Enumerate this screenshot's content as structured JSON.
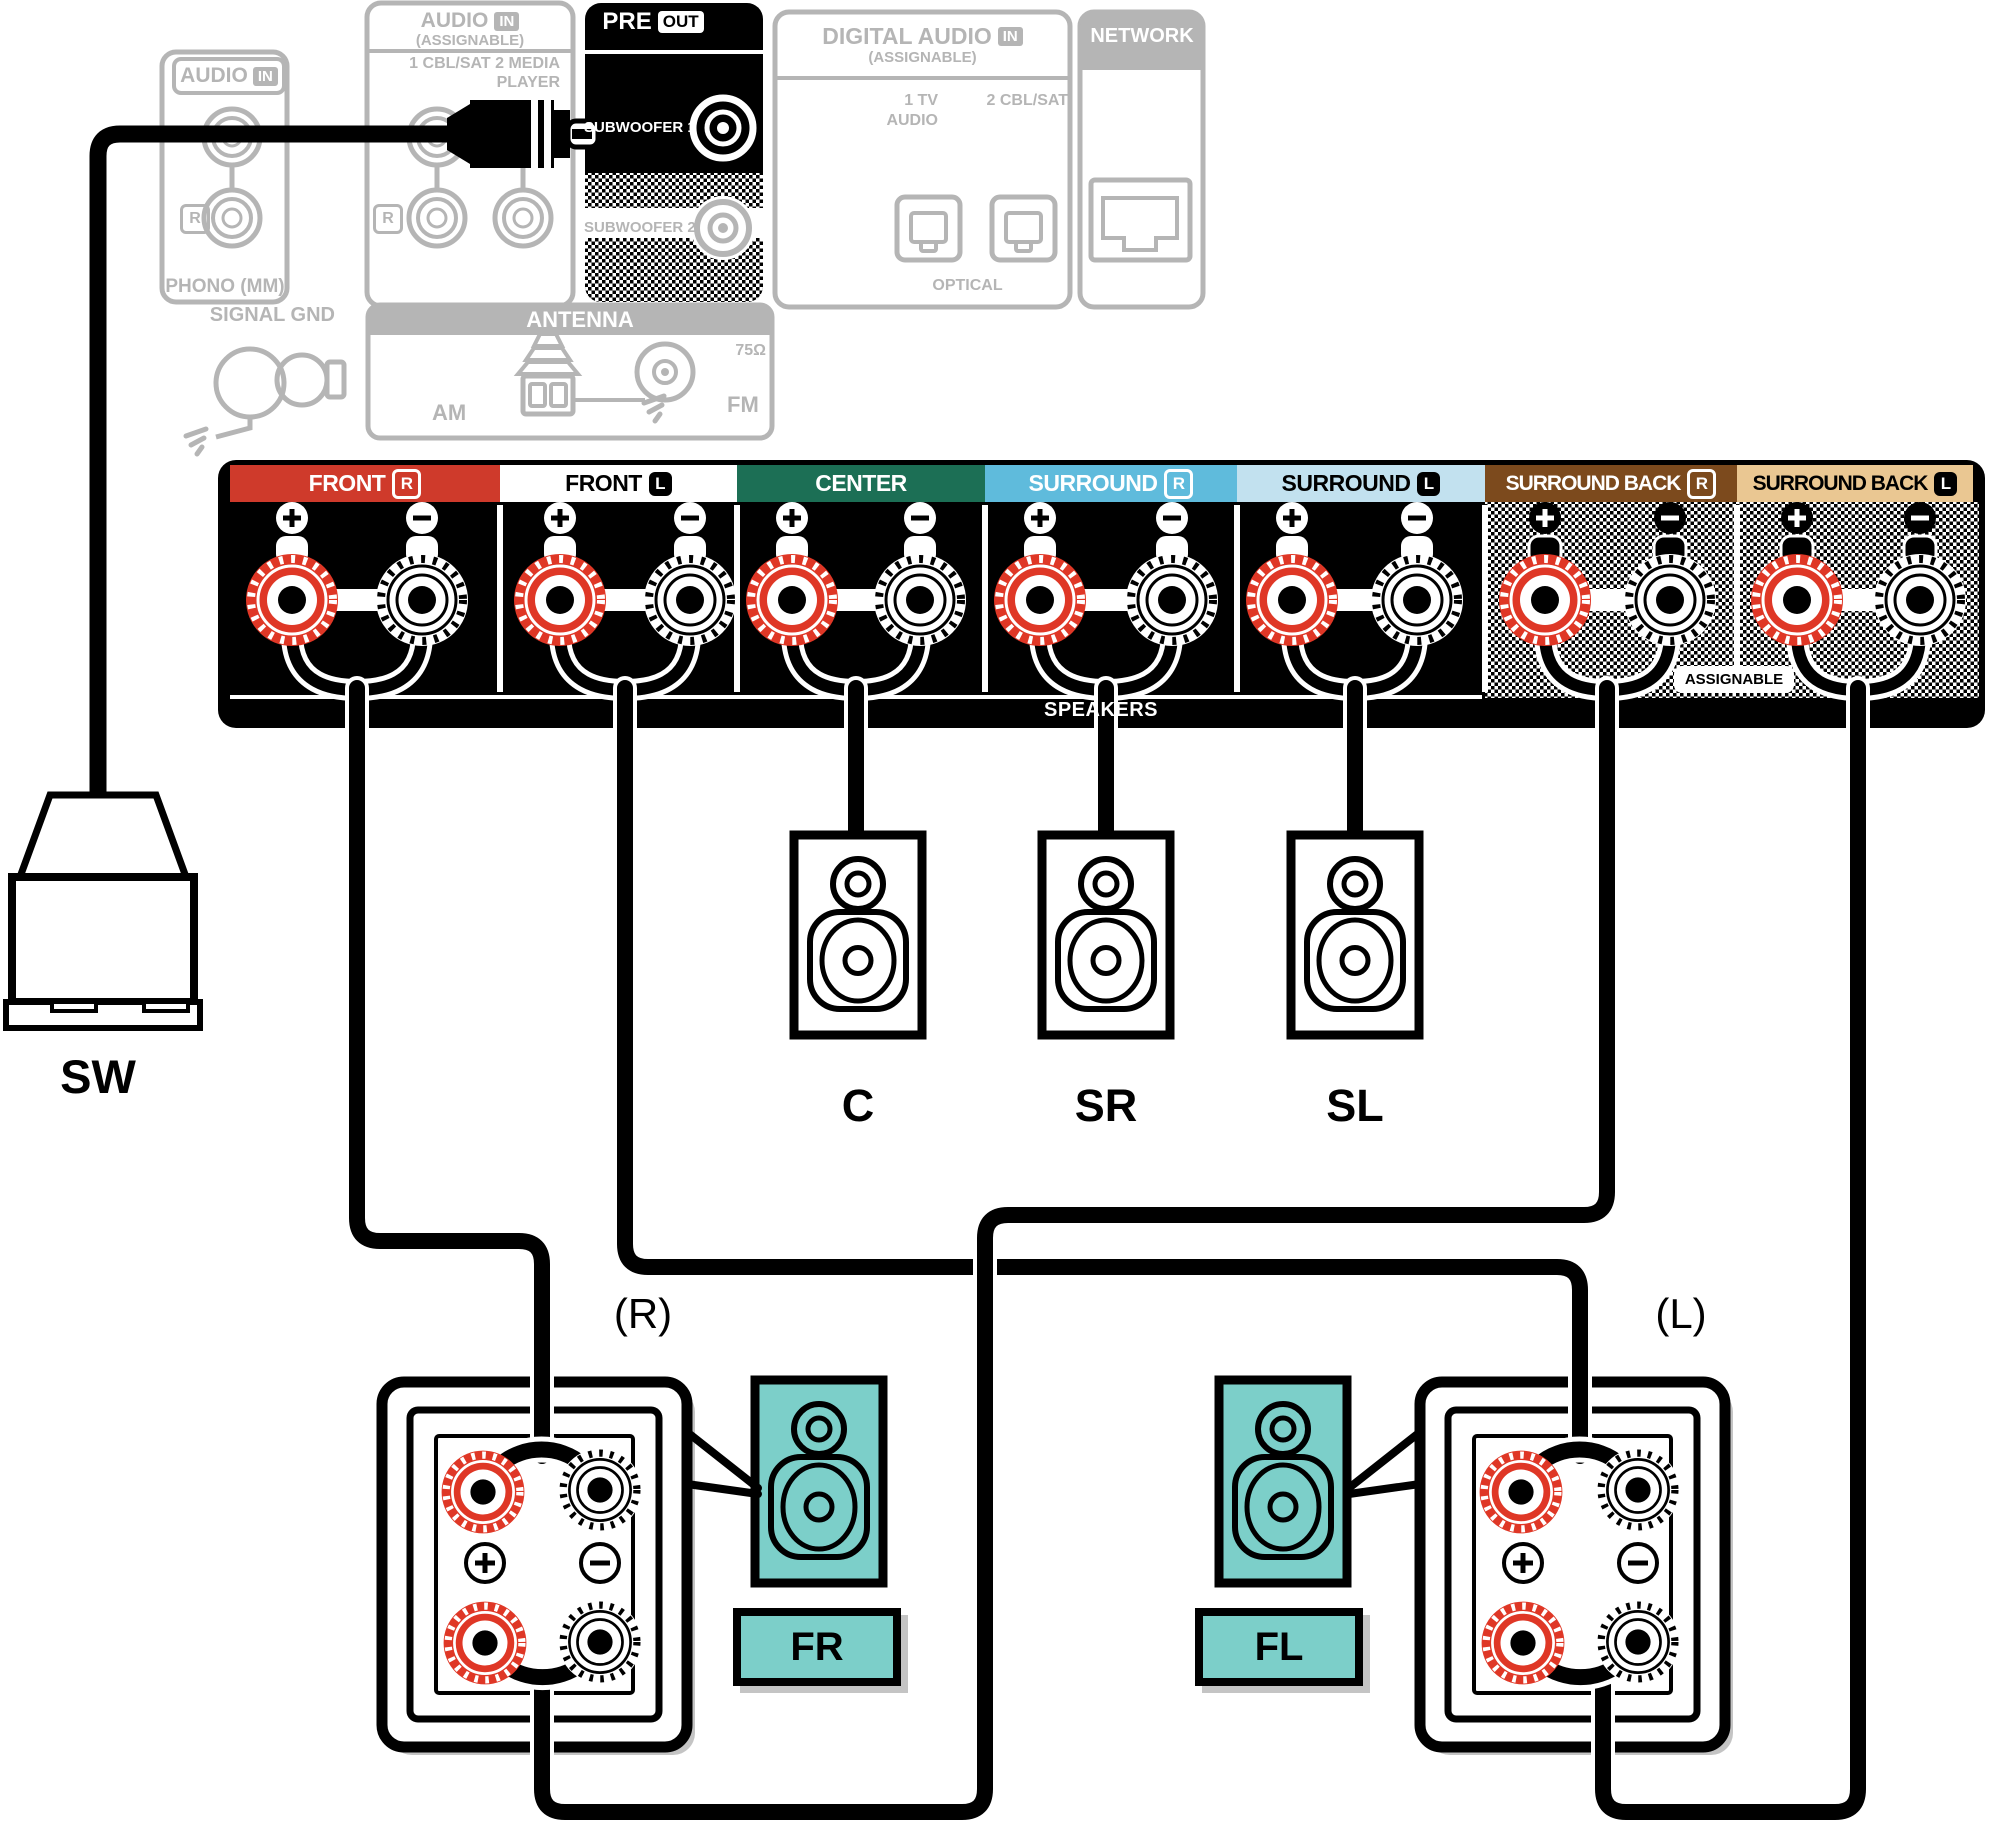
{
  "rear_panel": {
    "phono_section": {
      "header": "AUDIO",
      "header_badge": "IN",
      "channel": "R",
      "caption": "PHONO (MM)",
      "ground_label": "SIGNAL GND"
    },
    "assignable_audio_section": {
      "header": "AUDIO",
      "header_badge": "IN",
      "subheader": "(ASSIGNABLE)",
      "inputs_line1": "1 CBL/SAT  2 MEDIA",
      "inputs_line2": "PLAYER",
      "channel": "R"
    },
    "pre_out_section": {
      "header": "PRE",
      "header_badge": "OUT",
      "jack1": "SUBWOOFER 1",
      "jack2": "SUBWOOFER 2"
    },
    "digital_audio_section": {
      "header": "DIGITAL AUDIO",
      "header_badge": "IN",
      "subheader": "(ASSIGNABLE)",
      "input1_line1": "1  TV",
      "input1_line2": "AUDIO",
      "input2": "2 CBL/SAT",
      "caption": "OPTICAL"
    },
    "network_section": {
      "header": "NETWORK"
    },
    "antenna_section": {
      "header": "ANTENNA",
      "am_label": "AM",
      "fm_label": "FM",
      "impedance": "75Ω"
    }
  },
  "speaker_terminals": {
    "sections": [
      {
        "label": "FRONT",
        "badge": "R",
        "bg": "#cf3a2b",
        "fg": "#ffffff",
        "badge_style": "outline"
      },
      {
        "label": "FRONT",
        "badge": "L",
        "bg": "#ffffff",
        "fg": "#000000",
        "badge_style": "solid"
      },
      {
        "label": "CENTER",
        "badge": "",
        "bg": "#1c6f55",
        "fg": "#ffffff",
        "badge_style": ""
      },
      {
        "label": "SURROUND",
        "badge": "R",
        "bg": "#5fbbdc",
        "fg": "#ffffff",
        "badge_style": "outline"
      },
      {
        "label": "SURROUND",
        "badge": "L",
        "bg": "#c2e1ef",
        "fg": "#000000",
        "badge_style": "solid"
      },
      {
        "label": "SURROUND BACK",
        "badge": "R",
        "bg": "#7c4a1d",
        "fg": "#ffffff",
        "badge_style": "outline"
      },
      {
        "label": "SURROUND BACK",
        "badge": "L",
        "bg": "#eac792",
        "fg": "#000000",
        "badge_style": "solid"
      }
    ],
    "bottom_label": "SPEAKERS",
    "assignable_label": "ASSIGNABLE",
    "plus": "+",
    "minus": "−"
  },
  "devices": {
    "subwoofer": "SW",
    "center": "C",
    "surround_right": "SR",
    "surround_left": "SL",
    "front_right": "FR",
    "front_left": "FL",
    "right_channel_note": "(R)",
    "left_channel_note": "(L)"
  },
  "colors": {
    "terminal_red": "#df3726",
    "speaker_teal": "#7ccfc9",
    "panel_gray": "#b5b5b5",
    "shadow_gray": "#c4c4c4",
    "black": "#000000",
    "white": "#ffffff"
  }
}
